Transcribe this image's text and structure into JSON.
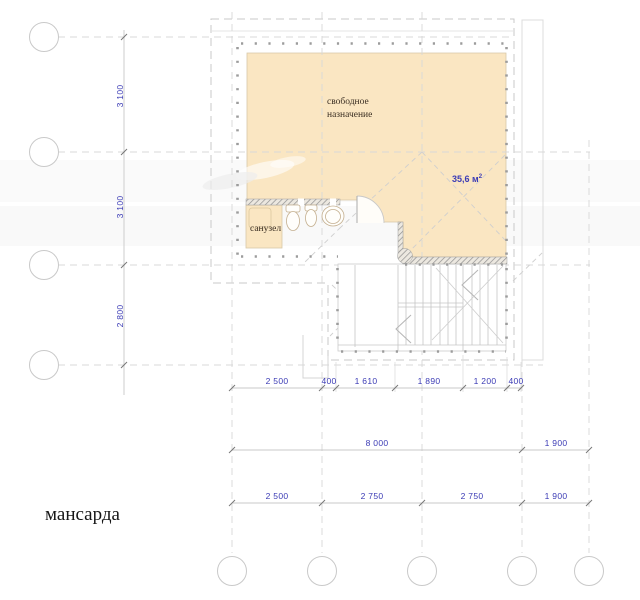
{
  "page": {
    "title": "мансарда"
  },
  "rooms": {
    "main": {
      "name_line1": "свободное",
      "name_line2": "назначение",
      "area_value": "35,6 м",
      "area_sup": "2"
    },
    "bathroom": {
      "name": "санузел"
    }
  },
  "dimensions": {
    "vertical_left": [
      "3 100",
      "3 100",
      "2 800"
    ],
    "horizontal_row1": [
      "2 500",
      "400",
      "1 610",
      "1 890",
      "1 200",
      "400"
    ],
    "horizontal_row2": [
      "8 000",
      "1 900"
    ],
    "horizontal_row3": [
      "2 500",
      "2 750",
      "2 750",
      "1 900"
    ]
  },
  "colors": {
    "room_fill": "#fae6c2",
    "dimension_text": "#3b3bb5",
    "drawing_lines": "#c9c9c9",
    "wall_dots": "#9c9c9c",
    "wall_hatch": "#8f8f8f"
  }
}
